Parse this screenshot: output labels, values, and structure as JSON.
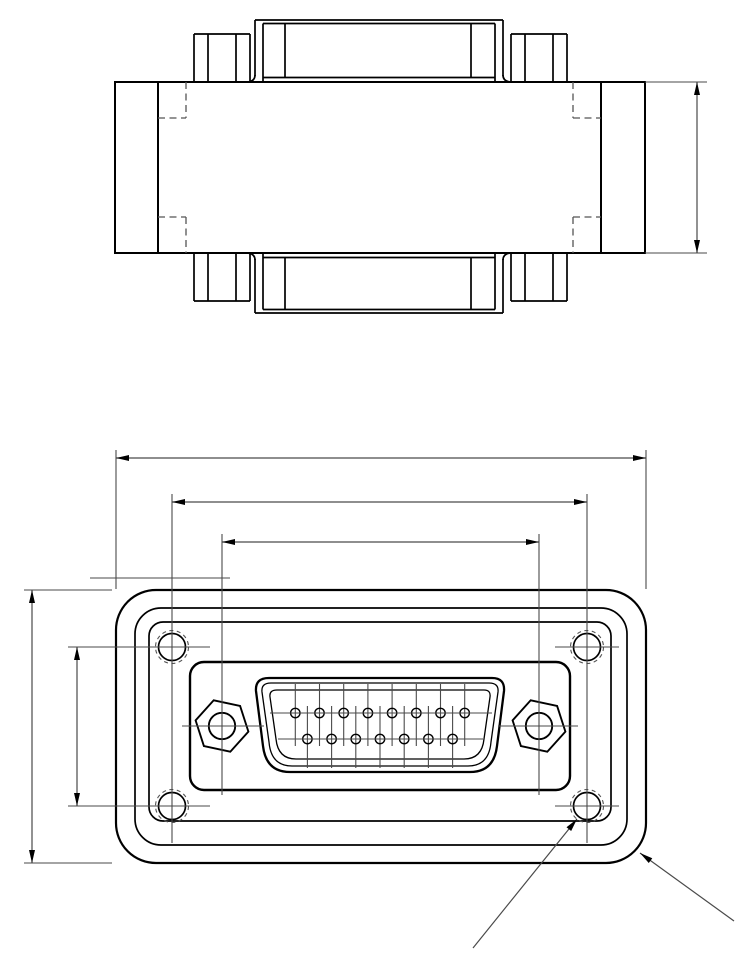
{
  "drawing": {
    "description": "Two-view engineering drawing of a DA-15 D-sub panel adapter",
    "canvas": {
      "w": 750,
      "h": 967,
      "bg": "#ffffff"
    },
    "colors": {
      "object": "#000000",
      "thin": "#4a4a4a",
      "hidden": "#555555",
      "text": "#000000"
    },
    "top_view": {
      "body_rect": {
        "x": 115,
        "y": 82,
        "w": 530,
        "h": 171,
        "sw": 2
      },
      "object_lines": [
        [
          158,
          82,
          158,
          253,
          2
        ],
        [
          601,
          82,
          601,
          253,
          2
        ],
        [
          255,
          20,
          503,
          20,
          1.7
        ],
        [
          255,
          20,
          255,
          76,
          1.7
        ],
        [
          503,
          20,
          503,
          76,
          1.7
        ],
        [
          263,
          23.5,
          495,
          23.5,
          1.7
        ],
        [
          263,
          23.5,
          263,
          82,
          1.7
        ],
        [
          495,
          23.5,
          495,
          82,
          1.7
        ],
        [
          285,
          23.5,
          285,
          77.5,
          1.7
        ],
        [
          471,
          23.5,
          471,
          77.5,
          1.7
        ],
        [
          263,
          77.5,
          495,
          77.5,
          1.7
        ],
        [
          194,
          82,
          194,
          34,
          1.7
        ],
        [
          194,
          34,
          250,
          34,
          1.7
        ],
        [
          250,
          34,
          250,
          82,
          1.7
        ],
        [
          208,
          34,
          208,
          82,
          1.7
        ],
        [
          236,
          34,
          236,
          82,
          1.7
        ],
        [
          511,
          82,
          511,
          34,
          1.7
        ],
        [
          511,
          34,
          567,
          34,
          1.7
        ],
        [
          567,
          34,
          567,
          82,
          1.7
        ],
        [
          525,
          34,
          525,
          82,
          1.7
        ],
        [
          553,
          34,
          553,
          82,
          1.7
        ],
        [
          255,
          313,
          503,
          313,
          1.7
        ],
        [
          255,
          259,
          255,
          313,
          1.7
        ],
        [
          503,
          259,
          503,
          313,
          1.7
        ],
        [
          263,
          309.5,
          495,
          309.5,
          1.7
        ],
        [
          263,
          253,
          263,
          309.5,
          1.7
        ],
        [
          495,
          253,
          495,
          309.5,
          1.7
        ],
        [
          285,
          257.5,
          285,
          309.5,
          1.7
        ],
        [
          471,
          257.5,
          471,
          309.5,
          1.7
        ],
        [
          263,
          257.5,
          495,
          257.5,
          1.7
        ],
        [
          194,
          253,
          194,
          301,
          1.7
        ],
        [
          194,
          301,
          250,
          301,
          1.7
        ],
        [
          250,
          301,
          250,
          253,
          1.7
        ],
        [
          208,
          253,
          208,
          301,
          1.7
        ],
        [
          236,
          253,
          236,
          301,
          1.7
        ],
        [
          511,
          253,
          511,
          301,
          1.7
        ],
        [
          511,
          301,
          567,
          301,
          1.7
        ],
        [
          567,
          301,
          567,
          253,
          1.7
        ],
        [
          525,
          253,
          525,
          301,
          1.7
        ],
        [
          553,
          253,
          553,
          301,
          1.7
        ]
      ],
      "fillet_paths": [
        "M 248 82 Q 255 81 255 75",
        "M 510 82 Q 503 81 503 75",
        "M 248 253 Q 255 254 255 260",
        "M 510 253 Q 503 254 503 260"
      ],
      "hidden_lines": [
        [
          186,
          82,
          186,
          118
        ],
        [
          158,
          118,
          186,
          118
        ],
        [
          573,
          82,
          573,
          118
        ],
        [
          573,
          118,
          601,
          118
        ],
        [
          186,
          217,
          186,
          253
        ],
        [
          158,
          217,
          186,
          217
        ],
        [
          573,
          217,
          573,
          253
        ],
        [
          573,
          217,
          601,
          217
        ]
      ]
    },
    "front_view": {
      "rounded_rects": [
        {
          "x": 116,
          "y": 590,
          "w": 530,
          "h": 273,
          "r": 40,
          "sw": 2.2,
          "name": "flange-outline-outer"
        },
        {
          "x": 135,
          "y": 608,
          "w": 492,
          "h": 237,
          "r": 26,
          "sw": 1.7,
          "name": "flange-outline-mid"
        },
        {
          "x": 149,
          "y": 622,
          "w": 462,
          "h": 199,
          "r": 14,
          "sw": 1.7,
          "name": "flange-outline-inner"
        },
        {
          "x": 190,
          "y": 662,
          "w": 380,
          "h": 128,
          "r": 14,
          "sw": 2.4,
          "name": "connector-boss"
        }
      ],
      "shell_paths": [
        {
          "d": "M 269 678 L 492 678 Q 505 678 504 691 L 497 746 Q 494 772 470 772 L 290 772 Q 266 772 263 746 L 256 691 Q 255 678 269 678 Z",
          "sw": 2.3,
          "name": "dsub-shell-outer"
        },
        {
          "d": "M 271 683 L 489 683 Q 499 683 498 692 L 491 742 Q 489 766 468 766 L 292 766 Q 271 766 269 742 L 262 692 Q 261 683 271 683 Z",
          "sw": 1.3,
          "name": "dsub-shell-inner"
        },
        {
          "d": "M 277 690 L 484 690 Q 491 690 490 697 L 484 739 Q 482 759 464 759 L 296 759 Q 278 759 276 739 L 270 697 Q 269 690 277 690 Z",
          "sw": 1.3,
          "name": "dsub-insulator"
        }
      ],
      "pins": {
        "r": 4.7,
        "sw": 1.4,
        "top_row": {
          "y": 713,
          "xs": [
            295.3,
            319.5,
            343.7,
            367.9,
            392.1,
            416.3,
            440.5,
            464.7
          ],
          "line_y1": 684,
          "line_y2": 746
        },
        "bottom_row": {
          "y": 739,
          "xs": [
            307.4,
            331.6,
            355.8,
            380,
            404.2,
            428.4,
            452.6
          ],
          "line_y1": 706,
          "line_y2": 768
        },
        "row_lines": [
          [
            270,
            713,
            492,
            713
          ],
          [
            278,
            739,
            483,
            739
          ]
        ]
      },
      "hex_nuts": {
        "centers": [
          [
            222,
            726
          ],
          [
            539,
            726
          ]
        ],
        "circumradius": 27,
        "rotation_deg": 12,
        "hole_radius": 13.2,
        "sw": 1.9
      },
      "corner_holes": {
        "centers": [
          [
            172,
            647
          ],
          [
            587,
            647
          ],
          [
            172,
            806
          ],
          [
            587,
            806
          ]
        ],
        "r": 13.5,
        "sw": 1.7,
        "thread_r": 16.5,
        "thread_sw": 1.1,
        "thread_dash": "4 3.5"
      },
      "centerlines": [
        [
          172,
          494,
          172,
          843
        ],
        [
          587,
          494,
          587,
          843
        ],
        [
          222,
          534,
          222,
          795
        ],
        [
          539,
          534,
          539,
          795
        ],
        [
          68,
          647,
          210,
          647
        ],
        [
          68,
          806,
          210,
          806
        ],
        [
          555,
          647,
          619,
          647
        ],
        [
          555,
          806,
          619,
          806
        ],
        [
          182,
          726,
          264,
          726
        ],
        [
          498,
          726,
          578,
          726
        ],
        [
          90,
          578,
          230,
          578
        ]
      ]
    },
    "dimensions": [
      {
        "id": "overall-width",
        "label": "55,79",
        "line": [
          116,
          458,
          646,
          458
        ],
        "exts": [
          [
            116,
            450,
            116,
            589
          ],
          [
            646,
            450,
            646,
            589
          ]
        ],
        "arrows": [
          [
            116,
            458,
            180
          ],
          [
            646,
            458,
            0
          ]
        ],
        "text": {
          "x": 382,
          "y": 442,
          "rot": 0
        }
      },
      {
        "id": "hole-spacing-x",
        "label": "43,64",
        "line": [
          172,
          502,
          587,
          502
        ],
        "exts": [],
        "arrows": [
          [
            172,
            502,
            180
          ],
          [
            587,
            502,
            0
          ]
        ],
        "text": {
          "x": 382,
          "y": 489,
          "rot": 0
        }
      },
      {
        "id": "jackscrew-spacing",
        "label": "33,3",
        "line": [
          222,
          542,
          539,
          542
        ],
        "exts": [],
        "arrows": [
          [
            222,
            542,
            180
          ],
          [
            539,
            542,
            0
          ]
        ],
        "text": {
          "x": 380,
          "y": 529,
          "rot": 0
        }
      },
      {
        "id": "overall-height",
        "label": "28,92",
        "line": [
          32,
          590,
          32,
          863
        ],
        "exts": [
          [
            24,
            590,
            112,
            590
          ],
          [
            24,
            863,
            112,
            863
          ]
        ],
        "arrows": [
          [
            32,
            590,
            -90
          ],
          [
            32,
            863,
            90
          ]
        ],
        "text": {
          "x": 17,
          "y": 726,
          "rot": -90
        }
      },
      {
        "id": "hole-spacing-y",
        "label": "16,76",
        "line": [
          77,
          647,
          77,
          806
        ],
        "exts": [],
        "arrows": [
          [
            77,
            647,
            -90
          ],
          [
            77,
            806,
            90
          ]
        ],
        "text": {
          "x": 61,
          "y": 726,
          "rot": -90
        }
      },
      {
        "id": "body-depth",
        "label": "18",
        "line": [
          697,
          82,
          697,
          253
        ],
        "exts": [
          [
            645,
            82,
            707,
            82
          ],
          [
            645,
            253,
            707,
            253
          ]
        ],
        "arrows": [
          [
            697,
            82,
            -90
          ],
          [
            697,
            253,
            90
          ]
        ],
        "text": {
          "x": 680,
          "y": 165,
          "rot": -90
        }
      }
    ],
    "leaders": [
      {
        "id": "thread-callout",
        "label": "4 x M3",
        "line": [
          473,
          948,
          577,
          819
        ],
        "arrow": [
          577,
          819,
          -51.1
        ],
        "text": {
          "x": 477,
          "y": 903,
          "rot": -51
        }
      },
      {
        "id": "radius-callout",
        "label": "R4,5",
        "line": [
          640,
          853,
          734,
          921
        ],
        "arrow": [
          640,
          853,
          -144.1
        ],
        "text": {
          "x": 712,
          "y": 896,
          "rot": 38
        }
      }
    ]
  }
}
